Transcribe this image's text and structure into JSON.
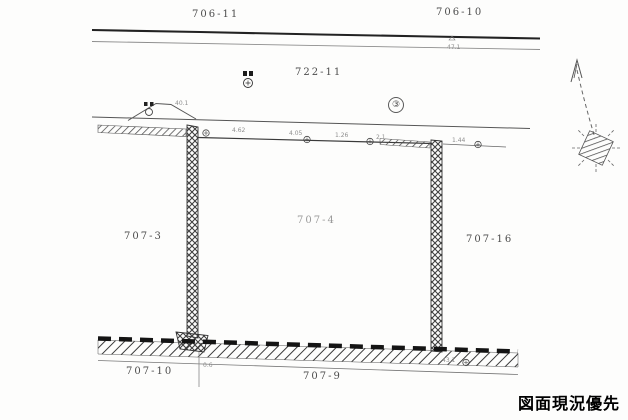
{
  "document": {
    "type": "cadastral-survey-drawing",
    "stamp_note": "図面現況優先",
    "parcels": {
      "p706_11": "706-11",
      "p706_10": "706-10",
      "p722_11": "722-11",
      "p707_3": "707-3",
      "p707_4": "707-4",
      "p707_16": "707-16",
      "p707_10": "707-10",
      "p707_9": "707-9"
    },
    "circled_point": "③",
    "annotations": {
      "top_road": "47.1",
      "bump": "40.1",
      "d1": "4.62",
      "d2": "4.05",
      "d3": "1.26",
      "d4": "2.1",
      "d5": "1.44",
      "bottom_left": "0.6",
      "bottom_right": "43.1"
    },
    "colors": {
      "ink": "#3d3d3d",
      "faint_ink": "#8f8f8f",
      "stamp": "#000000",
      "paper": "#fdfdfc"
    }
  }
}
